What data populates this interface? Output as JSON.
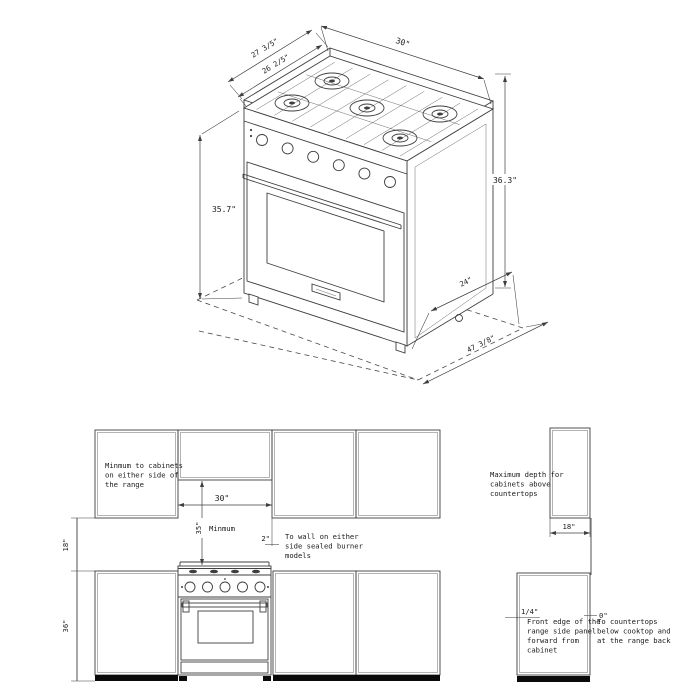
{
  "top_view": {
    "dims": {
      "width_top": "30\"",
      "depth_outer": "27 3/5\"",
      "depth_inner": "26 2/5\"",
      "height_back": "36.3\"",
      "height_front": "35.7\"",
      "floor_side": "24\"",
      "floor_front": "47 3/8\""
    }
  },
  "elevation": {
    "dims": {
      "range_width": "30\"",
      "min_vertical": "35\"",
      "min_vertical_word": "Minmum",
      "wall_side": "2\"",
      "counter_to_cabinet": "18\"",
      "counter_height": "36\"",
      "cabinet_depth": "18\"",
      "front_offset": "1/4\"",
      "back_contact": "0\""
    },
    "notes": {
      "side_clearance": [
        "Minmum to cabinets",
        "on either side of",
        "the range"
      ],
      "wall_clearance": [
        "To wall on either",
        "side sealed burner",
        "models"
      ],
      "max_depth": [
        "Maximum depth for",
        "cabinets above",
        "countertops"
      ],
      "front_edge": [
        "Front edge of the",
        "range side panel",
        "forward from",
        "cabinet"
      ],
      "countertop_contact": [
        "To countertops",
        "below cooktop and",
        "at the range back"
      ]
    }
  },
  "colors": {
    "line": "#3f3f3f",
    "text": "#1a1a1a",
    "background": "#ffffff",
    "toe_kick": "#0a0a0a"
  }
}
